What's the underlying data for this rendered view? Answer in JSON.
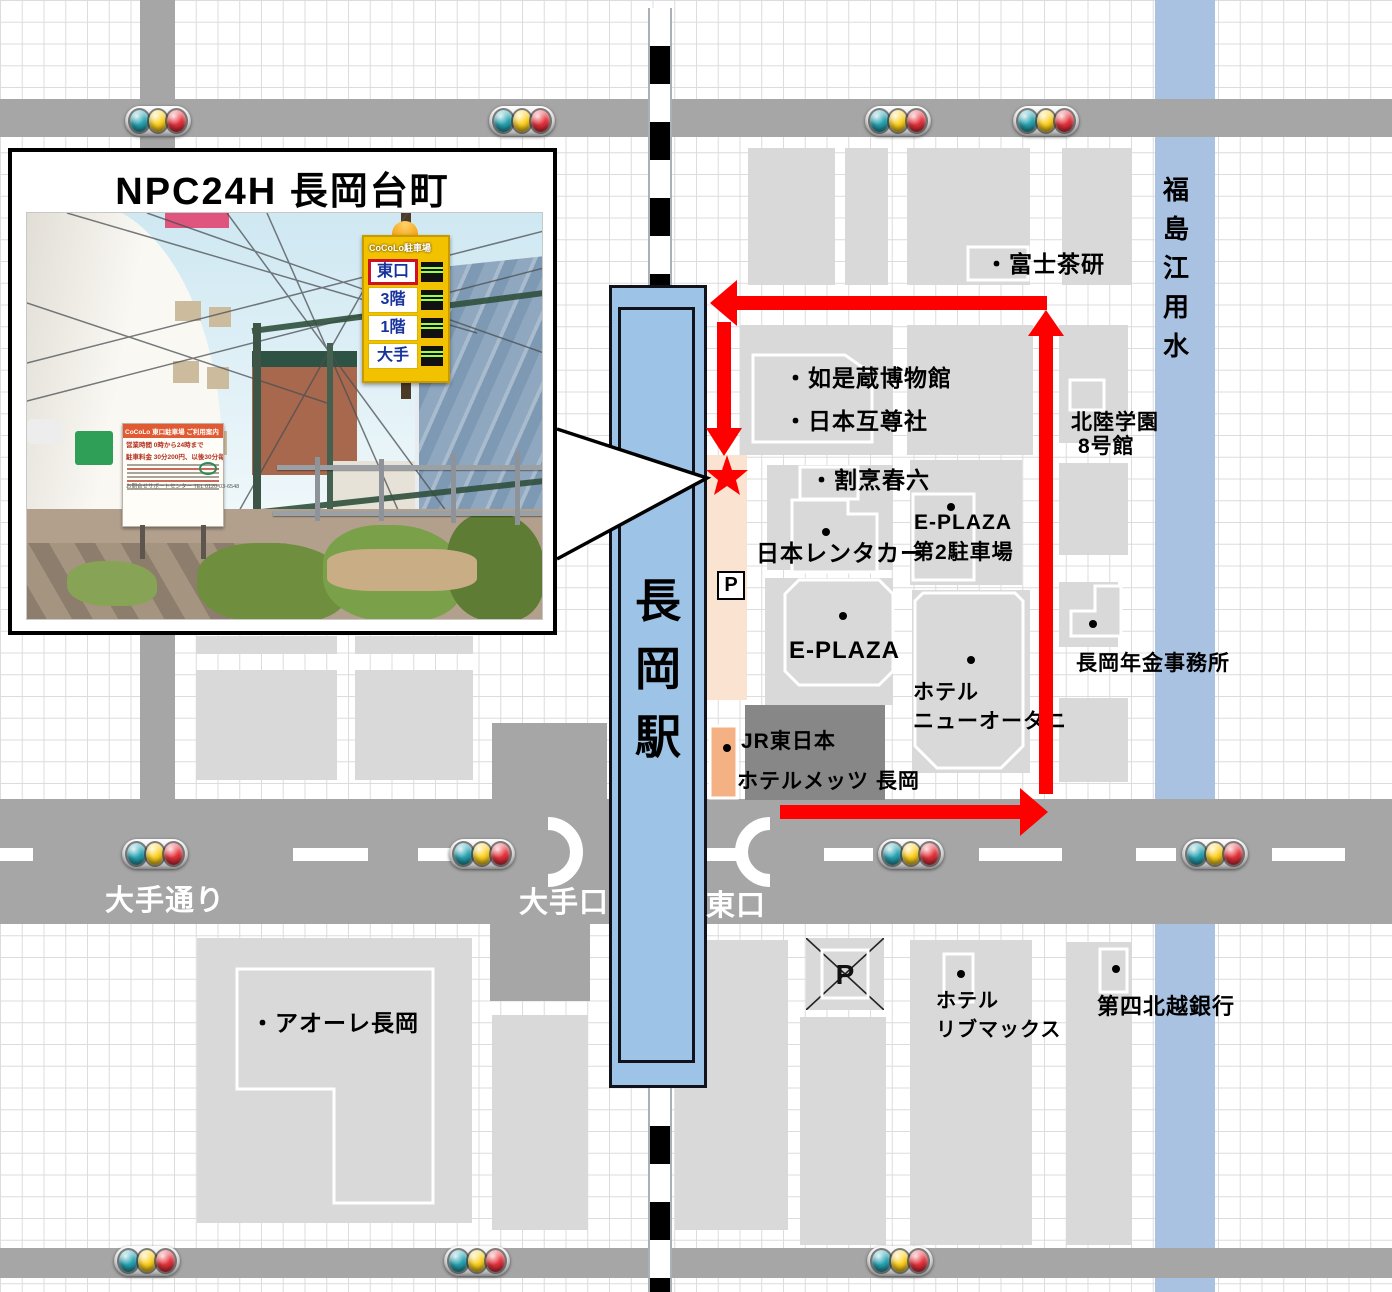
{
  "map": {
    "colors": {
      "road": "#a6a6a6",
      "plaza": "#878787",
      "building": "#d9d9d9",
      "canal": "#aac2e2",
      "station": "#9dc3e6",
      "peach": "#fbe3d1",
      "accent_red": "#fe0000",
      "metz_orange": "#f4b183",
      "grid": "#dcdcdc"
    },
    "station_name_chars": [
      "長",
      "岡",
      "駅"
    ],
    "canal_name_chars": [
      "福",
      "島",
      "江",
      "用",
      "水"
    ],
    "parking_p_label": "P",
    "roads": [
      {
        "name": "top-road",
        "x": 0,
        "y": 99,
        "w": 1392,
        "h": 38,
        "c": "road"
      },
      {
        "name": "vertical-road-topleft",
        "x": 140,
        "y": 0,
        "w": 35,
        "h": 800,
        "c": "road"
      },
      {
        "name": "main-road-ote-dori",
        "x": 0,
        "y": 799,
        "w": 1392,
        "h": 125,
        "c": "road"
      },
      {
        "name": "bottom-road",
        "x": 0,
        "y": 1248,
        "w": 1392,
        "h": 30,
        "c": "road"
      },
      {
        "name": "west-forecourt",
        "x": 492,
        "y": 723,
        "w": 115,
        "h": 77,
        "c": "road"
      },
      {
        "name": "south-forecourt",
        "x": 490,
        "y": 923,
        "w": 100,
        "h": 78,
        "c": "road"
      },
      {
        "name": "east-station-plaza",
        "x": 745,
        "y": 705,
        "w": 140,
        "h": 95,
        "c": "plaza"
      }
    ],
    "buildings": [
      [
        748,
        148,
        87,
        137
      ],
      [
        845,
        148,
        43,
        137
      ],
      [
        907,
        148,
        123,
        137
      ],
      [
        1062,
        148,
        70,
        137
      ],
      [
        740,
        325,
        153,
        130
      ],
      [
        907,
        325,
        126,
        130
      ],
      [
        1059,
        325,
        69,
        118
      ],
      [
        767,
        465,
        126,
        105
      ],
      [
        910,
        460,
        112,
        125
      ],
      [
        1059,
        463,
        69,
        92
      ],
      [
        765,
        578,
        128,
        127
      ],
      [
        912,
        590,
        118,
        183
      ],
      [
        1059,
        582,
        59,
        65
      ],
      [
        1059,
        698,
        69,
        84
      ],
      [
        196,
        636,
        141,
        18
      ],
      [
        355,
        636,
        118,
        18
      ],
      [
        196,
        670,
        141,
        110
      ],
      [
        355,
        670,
        118,
        110
      ],
      [
        197,
        938,
        275,
        285
      ],
      [
        492,
        1015,
        96,
        215
      ],
      [
        675,
        940,
        113,
        290
      ],
      [
        800,
        1017,
        86,
        228
      ],
      [
        910,
        940,
        122,
        305
      ],
      [
        1066,
        942,
        66,
        303
      ]
    ],
    "peach_strip": {
      "x": 706,
      "y": 455,
      "w": 41,
      "h": 245
    },
    "canal_band": {
      "x": 1155,
      "y": 0,
      "w": 60,
      "h": 1292
    },
    "railway": {
      "top": {
        "y": 8,
        "h": 279
      },
      "bottom": {
        "y": 1088,
        "h": 204
      }
    },
    "outlined_shapes": [
      {
        "name": "fuji-charen-building",
        "d": "M968,247 h60 v33 h-60 Z"
      },
      {
        "name": "nyozekura-museum-building",
        "d": "M753,355 L845,355 L872,374 L872,442 L753,442 Z"
      },
      {
        "name": "hokuriku-gakuen-building",
        "d": "M1070,380 h34 v30 h-34 Z"
      },
      {
        "name": "kappo-harumu-building",
        "d": "M800,467 h58 v32 h-58 Z"
      },
      {
        "name": "nippon-rentacar-building",
        "d": "M792,500 L848,500 L848,514 L877,514 L877,572 L792,572 Z"
      },
      {
        "name": "eplaza-lot2-building",
        "d": "M913,494 h61 v86 h-61 Z"
      },
      {
        "name": "eplaza-building",
        "d": "M799,580 L879,580 L893,594 L893,671 L879,685 L799,685 L785,671 L785,594 Z"
      },
      {
        "name": "hotel-new-otani-building",
        "d": "M923,593 L1015,593 L1023,601 L1023,746 L1001,768 L937,768 L915,746 L915,601 Z"
      },
      {
        "name": "pension-office-building",
        "d": "M1095,586 L1121,586 L1121,636 L1071,636 L1071,611 L1095,611 Z"
      },
      {
        "name": "aore-nagaoka-building",
        "d": "M237,969 L433,969 L433,1203 L334,1203 L334,1089 L237,1089 Z",
        "fill": "none"
      },
      {
        "name": "hotel-livemax-building",
        "d": "M944,954 h29 v48 h-29 Z"
      },
      {
        "name": "daishi-hokuetsu-bank-building",
        "d": "M1100,949 h27 v43 h-27 Z"
      },
      {
        "name": "hotel-mets-building",
        "d": "M710,726 h27 v72 h-27 Z",
        "fill": "#f4b183"
      }
    ],
    "labels": [
      {
        "name": "label-fuji-charen",
        "text": "・富士茶研",
        "x": 985,
        "y": 252,
        "s": 23
      },
      {
        "name": "label-nyozekura-museum",
        "text": "・如是蔵博物館",
        "x": 784,
        "y": 366,
        "s": 23
      },
      {
        "name": "label-nihon-gosonsha",
        "text": "・日本互尊社",
        "x": 784,
        "y": 409,
        "s": 23
      },
      {
        "name": "label-hokuriku-gakuen",
        "text": "北陸学園",
        "x": 1071,
        "y": 412,
        "s": 21
      },
      {
        "name": "label-hokuriku-8goukan",
        "text": "8号館",
        "x": 1078,
        "y": 436,
        "s": 21
      },
      {
        "name": "label-kappo-harumu",
        "text": "・割烹春六",
        "x": 810,
        "y": 468,
        "s": 23
      },
      {
        "name": "label-eplaza-lot2-1",
        "text": "E-PLAZA",
        "x": 914,
        "y": 512,
        "s": 21
      },
      {
        "name": "label-eplaza-lot2-2",
        "text": "第2駐車場",
        "x": 913,
        "y": 542,
        "s": 21
      },
      {
        "name": "label-nippon-rentacar",
        "text": "日本レンタカー",
        "x": 756,
        "y": 541,
        "s": 23
      },
      {
        "name": "label-eplaza",
        "text": "E-PLAZA",
        "x": 789,
        "y": 638,
        "s": 24
      },
      {
        "name": "label-hotel-new-otani-1",
        "text": "ホテル",
        "x": 913,
        "y": 682,
        "s": 21
      },
      {
        "name": "label-hotel-new-otani-2",
        "text": "ニューオータニ",
        "x": 913,
        "y": 711,
        "s": 21
      },
      {
        "name": "label-pension-office",
        "text": "長岡年金事務所",
        "x": 1076,
        "y": 653,
        "s": 21
      },
      {
        "name": "label-jr-east",
        "text": "JR東日本",
        "x": 741,
        "y": 731,
        "s": 21
      },
      {
        "name": "label-hotel-mets",
        "text": "ホテルメッツ 長岡",
        "x": 737,
        "y": 771,
        "s": 21
      },
      {
        "name": "label-ote-dori",
        "text": "大手通り",
        "x": 105,
        "y": 886,
        "s": 29,
        "c": "#fff"
      },
      {
        "name": "label-ote-guchi",
        "text": "大手口",
        "x": 519,
        "y": 888,
        "s": 29,
        "c": "#fff"
      },
      {
        "name": "label-higashi-guchi",
        "text": "東口",
        "x": 706,
        "y": 891,
        "s": 29,
        "c": "#fff"
      },
      {
        "name": "label-aore-nagaoka",
        "text": "・アオーレ長岡",
        "x": 251,
        "y": 1011,
        "s": 23
      },
      {
        "name": "label-hotel-livemax-1",
        "text": "ホテル",
        "x": 936,
        "y": 991,
        "s": 20
      },
      {
        "name": "label-hotel-livemax-2",
        "text": "リブマックス",
        "x": 936,
        "y": 1020,
        "s": 20
      },
      {
        "name": "label-daishi-hokuetsu-bank",
        "text": "第四北越銀行",
        "x": 1097,
        "y": 995,
        "s": 22
      }
    ],
    "dots": [
      [
        822,
        528
      ],
      [
        839,
        612
      ],
      [
        947,
        503
      ],
      [
        967,
        656
      ],
      [
        1089,
        620
      ],
      [
        723,
        744
      ],
      [
        957,
        970
      ],
      [
        1112,
        965
      ],
      [
        1045,
        391
      ]
    ],
    "traffic_lights": [
      {
        "x": 158,
        "y": 121
      },
      {
        "x": 522,
        "y": 121
      },
      {
        "x": 898,
        "y": 121
      },
      {
        "x": 1046,
        "y": 121
      },
      {
        "x": 155,
        "y": 854
      },
      {
        "x": 482,
        "y": 854
      },
      {
        "x": 911,
        "y": 854
      },
      {
        "x": 1215,
        "y": 854
      },
      {
        "x": 147,
        "y": 1261
      },
      {
        "x": 477,
        "y": 1261
      },
      {
        "x": 900,
        "y": 1261
      }
    ],
    "light_colors": [
      "#27a5b4",
      "#ffd21e",
      "#e8323c"
    ],
    "lane_dashes": [
      {
        "x": -15,
        "w": 48
      },
      {
        "x": 293,
        "w": 75
      },
      {
        "x": 418,
        "w": 74
      },
      {
        "x": 652,
        "w": 85
      },
      {
        "x": 824,
        "w": 49
      },
      {
        "x": 979,
        "w": 83
      },
      {
        "x": 1136,
        "w": 40
      },
      {
        "x": 1272,
        "w": 73
      }
    ],
    "route": {
      "shafts": [
        [
          737,
          296,
          310,
          14
        ],
        [
          1039,
          332,
          14,
          462
        ],
        [
          717,
          322,
          14,
          108
        ],
        [
          780,
          805,
          240,
          14
        ]
      ],
      "heads": [
        [
          [
            737,
            280
          ],
          [
            710,
            303
          ],
          [
            737,
            326
          ]
        ],
        [
          [
            1046,
            310
          ],
          [
            1028,
            336
          ],
          [
            1064,
            336
          ]
        ],
        [
          [
            706,
            428
          ],
          [
            742,
            428
          ],
          [
            724,
            456
          ]
        ],
        [
          [
            1020,
            788
          ],
          [
            1048,
            812
          ],
          [
            1020,
            836
          ]
        ]
      ],
      "star_points": "727,455 732,470 748,470 736,480 740,495 727,486 714,495 718,480 706,470 722,470",
      "pointer_path": "M557,429 L707,478 L557,559"
    },
    "p_box": {
      "x": 717,
      "y": 571,
      "w": 28,
      "h": 29
    },
    "crossed_p_box": {
      "x": 806,
      "y": 938,
      "w": 78,
      "h": 72
    }
  },
  "callout": {
    "title": "NPC24H 長岡台町",
    "photo": {
      "tower_sign": {
        "header": "CoCoLo駐車場",
        "rows": [
          {
            "label": "東口",
            "style": "red"
          },
          {
            "label": "3階",
            "style": ""
          },
          {
            "label": "1階",
            "style": ""
          },
          {
            "label": "大手",
            "style": ""
          }
        ]
      },
      "info_sign": {
        "header": "CoCoLo 東口駐車場 ご利用案内",
        "line1": "営業時間 0時から24時まで",
        "line2": "駐車料金 30分200円、以後30分毎に200円",
        "footer": "お問合せサポートセンター TEL 0120-03-6548"
      }
    }
  }
}
